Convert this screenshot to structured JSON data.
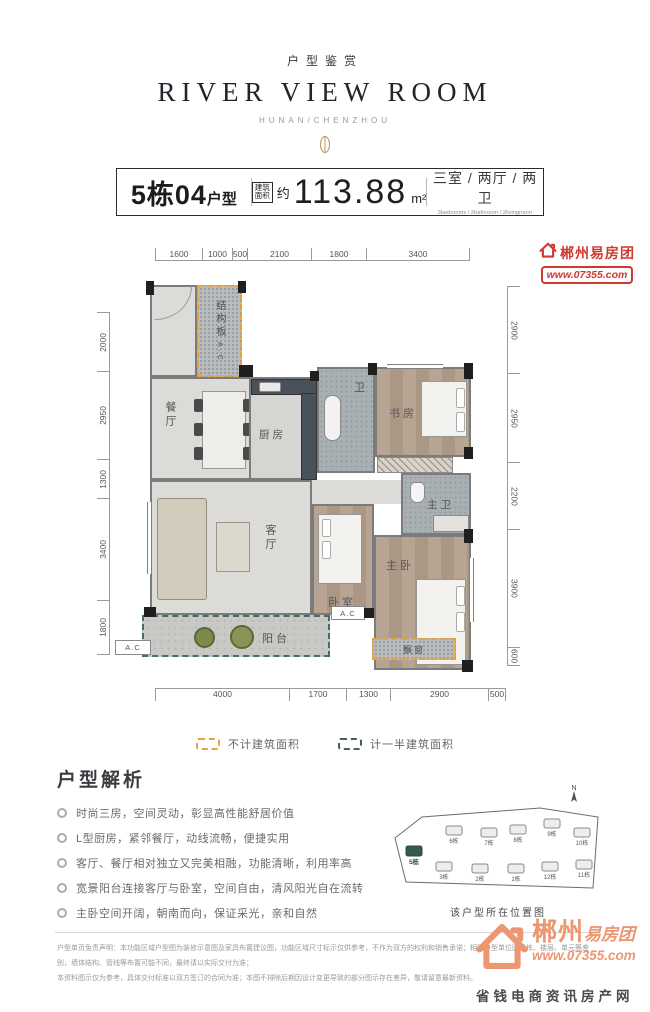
{
  "header": {
    "kicker": "户型鉴赏",
    "title": "RIVER VIEW ROOM",
    "subtitle": "HUNAN/CHENZHOU"
  },
  "spec": {
    "unit_number": "5栋04",
    "unit_suffix": "户型",
    "area_box_top": "建筑",
    "area_box_bottom": "面积",
    "area_approx": "约",
    "area_value": "113.88",
    "area_unit": "m²",
    "rooms_cn": "三室 / 两厅 / 两卫",
    "rooms_en": "3bedrooms / 2bathroom / 2livingroom"
  },
  "watermark": {
    "brand": "郴州易房团",
    "url": "www.07355.com"
  },
  "floor_plan": {
    "dims_top": [
      "1600",
      "1000",
      "500",
      "2100",
      "1800",
      "3400"
    ],
    "dims_bottom": [
      "4000",
      "1700",
      "1300",
      "2900",
      "500"
    ],
    "dims_left": [
      "2000",
      "2950",
      "1300",
      "3400",
      "1800"
    ],
    "dims_right": [
      "2900",
      "2950",
      "2200",
      "3900",
      "600"
    ],
    "rooms": {
      "structure": "结构板",
      "structure_ac": "A.C",
      "dining": "餐厅",
      "kitchen": "厨房",
      "bath": "卫",
      "study": "书房",
      "master_bath": "主卫",
      "living": "客厅",
      "bedroom": "卧室",
      "master_bedroom": "主卧",
      "balcony": "阳台",
      "bay_window": "飘窗",
      "ac_left": "A.C",
      "ac_mid": "A.C"
    }
  },
  "legend": {
    "items": [
      {
        "label": "不计建筑面积",
        "color": "#e8a23c"
      },
      {
        "label": "计一半建筑面积",
        "color": "#44605e"
      }
    ]
  },
  "analysis": {
    "title": "户型解析",
    "bullets": [
      "时尚三房，空间灵动，彰显高性能舒居价值",
      "L型厨房，紧邻餐厅，动线流畅，便捷实用",
      "客厅、餐厅相对独立又完美相融，功能清晰，利用率高",
      "宽景阳台连接客厅与卧室，空间自由，清风阳光自在流转",
      "主卧空间开阔，朝南而向，保证采光，亲和自然"
    ]
  },
  "site_map": {
    "compass": "N",
    "caption": "该户型所在位置图",
    "buildings": [
      {
        "label": "5栋",
        "highlight": true
      },
      {
        "label": "6栋"
      },
      {
        "label": "7栋"
      },
      {
        "label": "8栋"
      },
      {
        "label": "9栋"
      },
      {
        "label": "10栋"
      },
      {
        "label": "3栋"
      },
      {
        "label": "2栋"
      },
      {
        "label": "1栋"
      },
      {
        "label": "12栋"
      },
      {
        "label": "11栋"
      }
    ]
  },
  "footer": {
    "disclaimer_line1": "户型单页免责声明：本功能区域户型图为装修示意图及家具布置建议图，功能区域尺寸标示仅供参考，不作为双方的权利和销售承诺；相同户型单位因楼栋、楼层、单元等差别，墙体结构、管线等布置可能不同，最终请以实际交付为准；",
    "disclaimer_line2": "本资料图示仅为参考，具体交付标准以双方签订的合同为准；本图不排除后期因设计变更导致的部分图示存在差异，敬请留意最新资料。",
    "logo": {
      "city": "郴州",
      "brand": "易房团",
      "url": "www.07355.com",
      "tagline": "省钱电商资讯房产网"
    }
  },
  "colors": {
    "accent_orange": "#e8a23c",
    "accent_teal": "#3f6e6c",
    "logo_salmon": "#ec9672",
    "watermark_red": "#d0392e",
    "ornament_gold": "#b5985a"
  }
}
